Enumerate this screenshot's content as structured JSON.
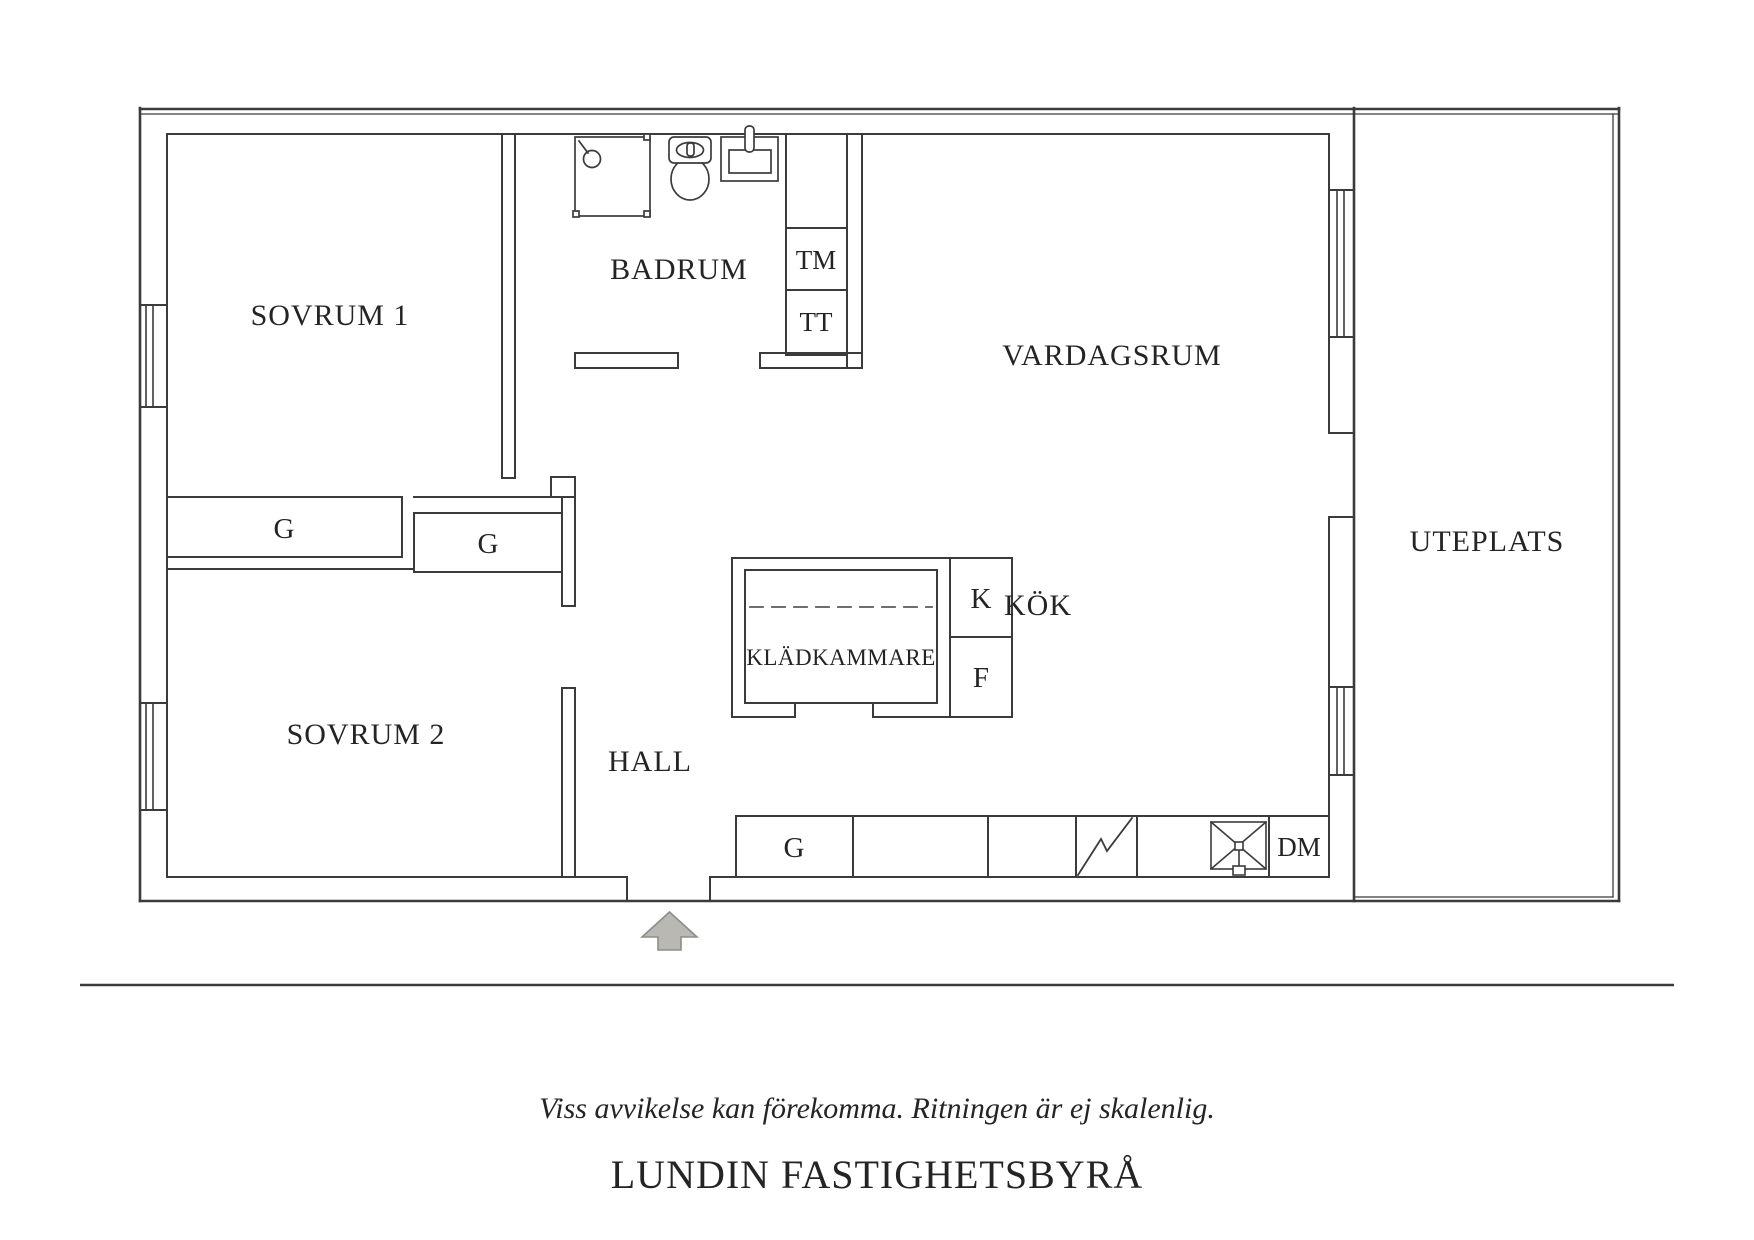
{
  "plan": {
    "rooms": {
      "sovrum1": {
        "label": "SOVRUM 1"
      },
      "badrum": {
        "label": "BADRUM"
      },
      "vardagsrum": {
        "label": "VARDAGSRUM"
      },
      "uteplats": {
        "label": "UTEPLATS"
      },
      "sovrum2": {
        "label": "SOVRUM 2"
      },
      "hall": {
        "label": "HALL"
      },
      "kladkammare": {
        "label": "KLÄDKAMMARE"
      },
      "kok": {
        "label": "KÖK"
      }
    },
    "closets": {
      "g1": {
        "label": "G"
      },
      "g2": {
        "label": "G"
      },
      "g3": {
        "label": "G"
      }
    },
    "appliances": {
      "tm": {
        "label": "TM"
      },
      "tt": {
        "label": "TT"
      },
      "k": {
        "label": "K"
      },
      "f": {
        "label": "F"
      },
      "dm": {
        "label": "DM"
      }
    },
    "colors": {
      "line": "#3b3b3b",
      "text": "#242424",
      "dash": "#5a5a5a",
      "arrow_fill": "#b9b8b2",
      "arrow_stroke": "#8e8e88"
    }
  },
  "footer": {
    "disclaimer": "Viss avvikelse kan förekomma. Ritningen är ej skalenlig.",
    "brand": "LUNDIN FASTIGHETSBYRÅ"
  }
}
